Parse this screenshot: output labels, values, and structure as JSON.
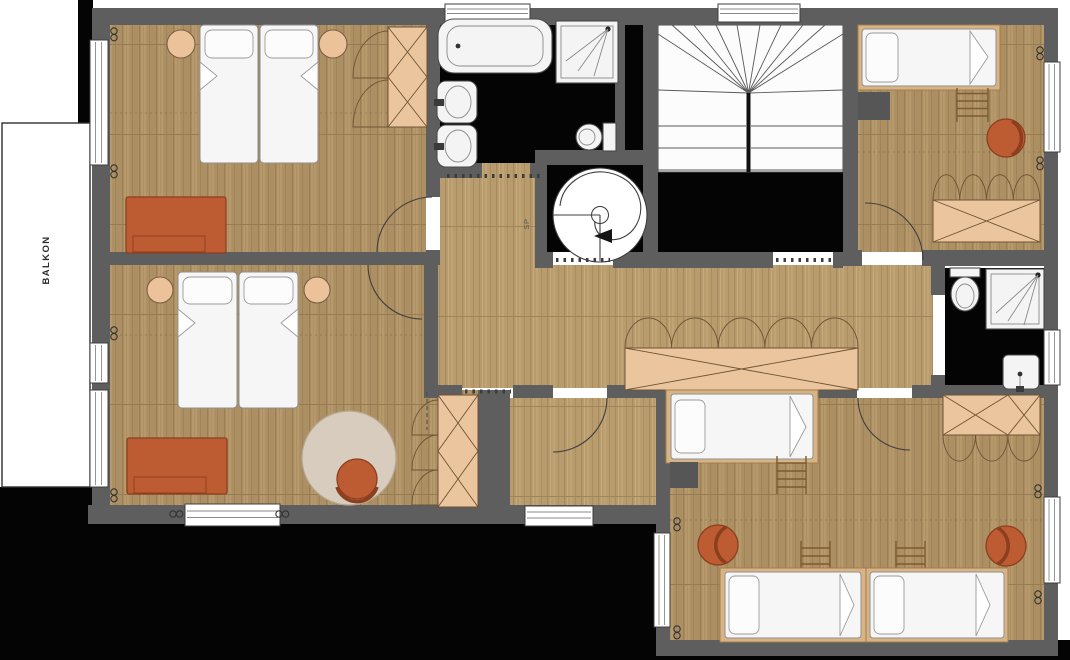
{
  "labels": {
    "balcony": "BALKON",
    "spiral_stair": "SP"
  },
  "palette": {
    "bg": "#ffffff",
    "wall": "#5e5e5e",
    "void": "#040404",
    "floor-wood": "#ac8f62",
    "floor-hall": "#b89c6e",
    "tan": "#eac59d",
    "tan-line": "#6f5436",
    "orange": "#bd5c33",
    "orange-dark": "#8c3f1e",
    "stool": "#ecc29b",
    "rug": "#d7ccbe",
    "fixture": "#f4f4f4",
    "frame-tan": "#d8b485",
    "dark-box": "#565656",
    "ladder": "#7c5a33"
  },
  "symbols": {
    "radiator": "coil-icon",
    "door": "door-swing-arc",
    "window": "window-glyph",
    "stairs": "winder-stairs",
    "spiral_stairs": "spiral-staircase"
  }
}
